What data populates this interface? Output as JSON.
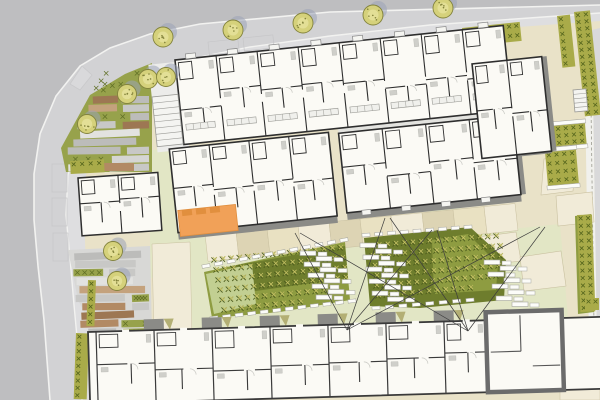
{
  "plan": {
    "kind": "architectural-site-plan",
    "width": 600,
    "height": 400
  },
  "palette": {
    "outerGray": "#bebec0",
    "road": "#d2d2d4",
    "sidewalk": "#dedee0",
    "curb": "#f2f2f0",
    "siteBeige": "#e9e2c8",
    "beigeDark": "#ddd4b4",
    "beigeLight": "#f1ebd8",
    "paleGreen": "#e2e6c5",
    "parkGreen": "#97a24b",
    "hedge": "#a9ab49",
    "hedgeX": "#55651d",
    "gardenMid": "#8e9c41",
    "gardenDark": "#6e7d2d",
    "lawn": "#c2cf92",
    "plantLight": "#c9c467",
    "stoneGrays": [
      "#e2e2e0",
      "#d5d5d3",
      "#c8c8c6",
      "#bcbcba"
    ],
    "browns": [
      "#b28a64",
      "#9d7753",
      "#c4a27d"
    ],
    "treeFill": "#d5d17b",
    "treeInner": "#e3df96",
    "treeEdge": "#83833c",
    "treeShadow": "#9aa2b6",
    "bldgFill": "#fbfaf5",
    "wallDark": "#2e2e2e",
    "wallGray": "#6b6b6b",
    "fixture": "#cfcfca",
    "shadowBand": "#8b8b87",
    "porchOlive": "#b3af74",
    "orange": "#f1a158",
    "orangeDark": "#e18f3e",
    "stoneWhite": "#fcfcf9",
    "stoneEdge": "#a6a69e",
    "lineDark": "#3c3c3c",
    "pathEdge": "#c9c0a0"
  },
  "roads": {
    "road_poly": [
      [
        0,
        0
      ],
      [
        600,
        0
      ],
      [
        600,
        13
      ],
      [
        430,
        25
      ],
      [
        330,
        36
      ],
      [
        250,
        47
      ],
      [
        195,
        58
      ],
      [
        155,
        70
      ],
      [
        120,
        88
      ],
      [
        95,
        110
      ],
      [
        76,
        140
      ],
      [
        68,
        175
      ],
      [
        66,
        215
      ],
      [
        70,
        258
      ],
      [
        74,
        305
      ],
      [
        78,
        348
      ],
      [
        82,
        400
      ],
      [
        0,
        400
      ]
    ],
    "outer_poly": [
      [
        0,
        0
      ],
      [
        600,
        0
      ],
      [
        600,
        5
      ],
      [
        330,
        12
      ],
      [
        200,
        24
      ],
      [
        150,
        34
      ],
      [
        110,
        48
      ],
      [
        80,
        66
      ],
      [
        56,
        96
      ],
      [
        40,
        134
      ],
      [
        34,
        174
      ],
      [
        34,
        220
      ],
      [
        38,
        266
      ],
      [
        44,
        320
      ],
      [
        50,
        400
      ],
      [
        0,
        400
      ]
    ],
    "outer_curb": [
      [
        600,
        5
      ],
      [
        330,
        12
      ],
      [
        200,
        24
      ],
      [
        150,
        34
      ],
      [
        110,
        48
      ],
      [
        80,
        66
      ],
      [
        56,
        96
      ],
      [
        40,
        134
      ],
      [
        34,
        174
      ],
      [
        34,
        220
      ],
      [
        38,
        266
      ],
      [
        44,
        320
      ],
      [
        50,
        400
      ]
    ],
    "inner_curb": [
      [
        600,
        13
      ],
      [
        430,
        25
      ],
      [
        330,
        36
      ],
      [
        250,
        47
      ],
      [
        195,
        58
      ],
      [
        155,
        70
      ],
      [
        120,
        88
      ],
      [
        95,
        110
      ],
      [
        76,
        140
      ],
      [
        68,
        175
      ],
      [
        66,
        215
      ],
      [
        70,
        258
      ],
      [
        74,
        305
      ],
      [
        78,
        348
      ],
      [
        82,
        400
      ]
    ],
    "sidewalk_poly": [
      [
        600,
        13
      ],
      [
        430,
        25
      ],
      [
        330,
        36
      ],
      [
        250,
        47
      ],
      [
        195,
        58
      ],
      [
        155,
        70
      ],
      [
        120,
        88
      ],
      [
        95,
        110
      ],
      [
        76,
        140
      ],
      [
        68,
        175
      ],
      [
        66,
        215
      ],
      [
        70,
        258
      ],
      [
        74,
        305
      ],
      [
        78,
        348
      ],
      [
        82,
        400
      ],
      [
        96,
        400
      ],
      [
        92,
        330
      ],
      [
        86,
        268
      ],
      [
        84,
        215
      ],
      [
        86,
        175
      ],
      [
        94,
        142
      ],
      [
        112,
        112
      ],
      [
        134,
        94
      ],
      [
        162,
        79
      ],
      [
        210,
        66
      ],
      [
        262,
        55
      ],
      [
        340,
        44
      ],
      [
        436,
        33
      ],
      [
        600,
        21
      ]
    ],
    "kite_marking": [
      [
        70,
        84
      ],
      [
        82,
        66
      ],
      [
        92,
        75
      ],
      [
        80,
        90
      ]
    ],
    "parking_bays": [
      [
        52,
        164,
        15,
        28,
        0
      ],
      [
        52,
        198,
        15,
        28,
        0
      ],
      [
        53,
        233,
        15,
        28,
        0
      ],
      [
        208,
        42,
        30,
        13,
        -6
      ],
      [
        243,
        38,
        30,
        13,
        -6
      ]
    ],
    "right_white_strip": [
      [
        584,
        30
      ],
      [
        592,
        30
      ],
      [
        598,
        400
      ],
      [
        590,
        400
      ]
    ],
    "right_gray_strip": [
      [
        592,
        30
      ],
      [
        600,
        28
      ],
      [
        600,
        400
      ],
      [
        598,
        400
      ]
    ],
    "boundary_dash": [
      590,
      32,
      595,
      400
    ]
  },
  "park": {
    "upper_poly": [
      [
        90,
        95
      ],
      [
        125,
        74
      ],
      [
        152,
        63
      ],
      [
        152,
        172
      ],
      [
        66,
        172
      ],
      [
        61,
        148
      ]
    ],
    "lower_poly": [
      [
        68,
        250
      ],
      [
        150,
        246
      ],
      [
        152,
        335
      ],
      [
        96,
        335
      ],
      [
        78,
        300
      ]
    ],
    "stone_rows": [
      [
        96,
        168
      ],
      [
        252,
        330
      ]
    ],
    "left_edge": [
      [
        90,
        92
      ],
      [
        66,
        140
      ],
      [
        62,
        175
      ],
      [
        63,
        215
      ],
      [
        66,
        250
      ],
      [
        70,
        290
      ],
      [
        78,
        320
      ],
      [
        84,
        335
      ]
    ],
    "right_edge_x": 150,
    "beds": [
      {
        "type": "brown",
        "x": 104,
        "y": 163,
        "w": 30,
        "h": 8
      }
    ],
    "beige_path": [
      [
        152,
        244
      ],
      [
        190,
        242
      ],
      [
        192,
        338
      ],
      [
        154,
        340
      ]
    ]
  },
  "trees": {
    "radius": 10,
    "street": [
      [
        163,
        37
      ],
      [
        233,
        30
      ],
      [
        303,
        23
      ],
      [
        373,
        15
      ],
      [
        443,
        8
      ]
    ],
    "park": [
      [
        148,
        79
      ],
      [
        166,
        77
      ],
      [
        127,
        94
      ],
      [
        87,
        124
      ],
      [
        113,
        251
      ],
      [
        117,
        281
      ]
    ]
  },
  "hedges": [
    {
      "x": 225,
      "y": 63,
      "w": 54,
      "h": 20,
      "rot": -6
    },
    {
      "x": 316,
      "y": 50,
      "w": 68,
      "h": 23,
      "rot": -6
    },
    {
      "x": 419,
      "y": 44,
      "w": 30,
      "h": 13,
      "rot": -6
    },
    {
      "x": 462,
      "y": 28,
      "w": 58,
      "h": 19,
      "rot": -6
    },
    {
      "x": 557,
      "y": 16,
      "w": 13,
      "h": 52,
      "rot": -6
    },
    {
      "x": 574,
      "y": 12,
      "w": 16,
      "h": 105,
      "rot": -6
    },
    {
      "x": 577,
      "y": 215,
      "w": 15,
      "h": 97,
      "rot": -2
    },
    {
      "x": 585,
      "y": 298,
      "w": 14,
      "h": 12,
      "rot": 0
    },
    {
      "x": 76,
      "y": 333,
      "w": 13,
      "h": 66,
      "rot": 2
    },
    {
      "x": 88,
      "y": 280,
      "w": 8,
      "h": 46,
      "rot": 2
    },
    {
      "x": 70,
      "y": 161,
      "w": 34,
      "h": 13,
      "rot": -3
    }
  ],
  "planters": [
    {
      "x": 539,
      "y": 127,
      "w": 46,
      "h": 21,
      "rot": -5
    },
    {
      "x": 545,
      "y": 152,
      "w": 31,
      "h": 34,
      "rot": -5
    }
  ],
  "courtyard_greens": [
    [
      [
        150,
        150
      ],
      [
        233,
        146
      ],
      [
        240,
        268
      ],
      [
        150,
        278
      ]
    ],
    [
      [
        190,
        262
      ],
      [
        560,
        224
      ],
      [
        568,
        318
      ],
      [
        190,
        338
      ]
    ],
    [
      [
        430,
        208
      ],
      [
        462,
        204
      ],
      [
        456,
        234
      ],
      [
        426,
        236
      ]
    ],
    [
      [
        488,
        298
      ],
      [
        532,
        294
      ],
      [
        534,
        322
      ],
      [
        486,
        324
      ]
    ]
  ],
  "right_paths": [
    [
      [
        470,
        238
      ],
      [
        516,
        232
      ],
      [
        521,
        261
      ],
      [
        466,
        267
      ]
    ],
    [
      [
        520,
        257
      ],
      [
        561,
        251
      ],
      [
        566,
        286
      ],
      [
        524,
        291
      ]
    ],
    [
      [
        544,
        159
      ],
      [
        576,
        155
      ],
      [
        573,
        191
      ],
      [
        541,
        195
      ]
    ],
    [
      [
        428,
        150
      ],
      [
        470,
        144
      ],
      [
        466,
        171
      ],
      [
        426,
        176
      ]
    ],
    [
      [
        556,
        196
      ],
      [
        592,
        192
      ],
      [
        594,
        222
      ],
      [
        558,
        226
      ]
    ]
  ],
  "right_blocks": [
    {
      "x": 560,
      "y": 318,
      "w": 40,
      "h": 26,
      "tone": "light"
    },
    {
      "x": 560,
      "y": 344,
      "w": 40,
      "h": 30,
      "tone": "dark"
    },
    {
      "x": 560,
      "y": 374,
      "w": 40,
      "h": 26,
      "tone": "light"
    }
  ],
  "terraces": {
    "upper": {
      "x0": 205,
      "x1": 515,
      "n": 10,
      "lineX": 178,
      "lineY": 230,
      "slope": -0.0994,
      "gap": 7,
      "depth": 27
    },
    "lower": {
      "x0": 96,
      "x1": 596,
      "n": 16,
      "lineX": 88,
      "lineY": 330,
      "slope": -0.0293,
      "gap": 2,
      "depth": 16
    }
  },
  "gardens": {
    "left": {
      "poly": [
        [
          204,
          272
        ],
        [
          268,
          258
        ],
        [
          345,
          242
        ],
        [
          350,
          300
        ],
        [
          280,
          312
        ],
        [
          212,
          318
        ]
      ],
      "dark": [
        [
          232,
          266
        ],
        [
          345,
          246
        ],
        [
          348,
          278
        ],
        [
          234,
          294
        ]
      ],
      "lawn": [
        [
          206,
          274
        ],
        [
          252,
          264
        ],
        [
          256,
          304
        ],
        [
          214,
          314
        ]
      ],
      "rows": [
        [
          214,
          260,
          340,
          248
        ],
        [
          216,
          270,
          342,
          258
        ],
        [
          218,
          280,
          344,
          268
        ],
        [
          220,
          290,
          345,
          278
        ],
        [
          222,
          300,
          332,
          290
        ],
        [
          224,
          310,
          300,
          302
        ]
      ]
    },
    "right": {
      "poly": [
        [
          364,
          238
        ],
        [
          470,
          227
        ],
        [
          506,
          260
        ],
        [
          504,
          300
        ],
        [
          420,
          308
        ],
        [
          370,
          306
        ]
      ],
      "dark": [
        [
          368,
          242
        ],
        [
          466,
          232
        ],
        [
          498,
          262
        ],
        [
          496,
          296
        ],
        [
          420,
          303
        ],
        [
          372,
          300
        ]
      ],
      "lawn": [
        [
          432,
          240
        ],
        [
          468,
          234
        ],
        [
          498,
          264
        ],
        [
          496,
          290
        ],
        [
          434,
          294
        ]
      ],
      "rows": [
        [
          370,
          246,
          496,
          236
        ],
        [
          372,
          256,
          500,
          246
        ],
        [
          374,
          266,
          500,
          256
        ],
        [
          376,
          276,
          498,
          266
        ],
        [
          376,
          286,
          496,
          276
        ],
        [
          378,
          296,
          470,
          288
        ]
      ]
    },
    "edge_strip": {
      "poly": [
        [
          575,
          216
        ],
        [
          591,
          214
        ],
        [
          594,
          312
        ],
        [
          578,
          314
        ]
      ],
      "row": [
        581,
        220,
        583,
        308
      ]
    },
    "stone_rows": [
      [
        206,
        266,
        344,
        240
      ],
      [
        214,
        318,
        352,
        301
      ],
      [
        366,
        235,
        468,
        227
      ],
      [
        376,
        308,
        470,
        300
      ]
    ]
  },
  "brick_stacks": [
    {
      "x": 300,
      "y": 251,
      "n": 9,
      "alt": 14,
      "step": 2,
      "dy": 5.5
    },
    {
      "x": 360,
      "y": 243,
      "n": 10,
      "alt": 14,
      "step": 1.5,
      "dy": 6
    },
    {
      "x": 484,
      "y": 260,
      "n": 8,
      "alt": 14,
      "step": 2,
      "dy": 6
    }
  ],
  "sight_lines": [
    [
      295,
      233,
      347,
      330
    ],
    [
      300,
      233,
      468,
      331
    ],
    [
      385,
      218,
      347,
      330
    ],
    [
      390,
      218,
      468,
      331
    ],
    [
      432,
      230,
      347,
      330
    ],
    [
      437,
      230,
      468,
      331
    ],
    [
      540,
      227,
      347,
      330
    ],
    [
      545,
      227,
      468,
      331
    ]
  ],
  "buildings": {
    "top_complex": {
      "rot": -6,
      "cx": 175,
      "cy": 60,
      "slabs": [
        {
          "x": 175,
          "y": 60,
          "w": 330,
          "h": 85,
          "units": 8,
          "counters": true
        },
        {
          "x": 160,
          "y": 148,
          "w": 160,
          "h": 84,
          "units": 4,
          "counters": false
        },
        {
          "x": 330,
          "y": 150,
          "w": 175,
          "h": 80,
          "units": 4,
          "counters": false
        },
        {
          "x": 470,
          "y": 95,
          "w": 70,
          "h": 95,
          "units": 2,
          "counters": false
        }
      ],
      "bay_tabs": {
        "x0": 186,
        "step": 42,
        "n": 8,
        "y": 55,
        "w": 10,
        "h": 5
      },
      "south_tabs": {
        "x0": 345,
        "step": 40,
        "n": 4,
        "y": 229,
        "w": 9,
        "h": 5
      },
      "corridor": [
        330,
        144,
        175,
        7
      ],
      "terrace_slab": [
        148,
        62,
        32,
        88
      ],
      "shadows": [
        [
          330,
          230,
          175,
          7
        ],
        [
          160,
          232,
          160,
          7
        ],
        [
          470,
          185,
          70,
          7
        ],
        [
          540,
          95,
          5,
          95
        ],
        [
          505,
          150,
          5,
          80
        ]
      ],
      "orange": {
        "x": 162,
        "y": 210,
        "w": 58,
        "h": 26,
        "notches": 3
      }
    },
    "west_block": {
      "rot": -4,
      "cx": 78,
      "cy": 178,
      "x": 78,
      "y": 178,
      "w": 80,
      "h": 58,
      "units": 2
    },
    "bottom_row": {
      "rot": -1.7,
      "cx": 90,
      "cy": 332,
      "x": 88,
      "y": 332,
      "w": 520,
      "h": 72,
      "partitions": [
        96,
        154,
        212,
        270,
        328,
        386,
        444
      ],
      "porch_xs": [
        154,
        212,
        270,
        328,
        386,
        444
      ],
      "gray_unit": {
        "x": 486,
        "y": 324,
        "w": 76,
        "h": 80
      }
    }
  },
  "stairs": [
    {
      "x": 152,
      "y": 97,
      "w": 26,
      "h": 50,
      "rot": -6,
      "treads": 8
    },
    {
      "x": 573,
      "y": 90,
      "w": 13,
      "h": 22,
      "rot": -5,
      "treads": 5
    }
  ]
}
